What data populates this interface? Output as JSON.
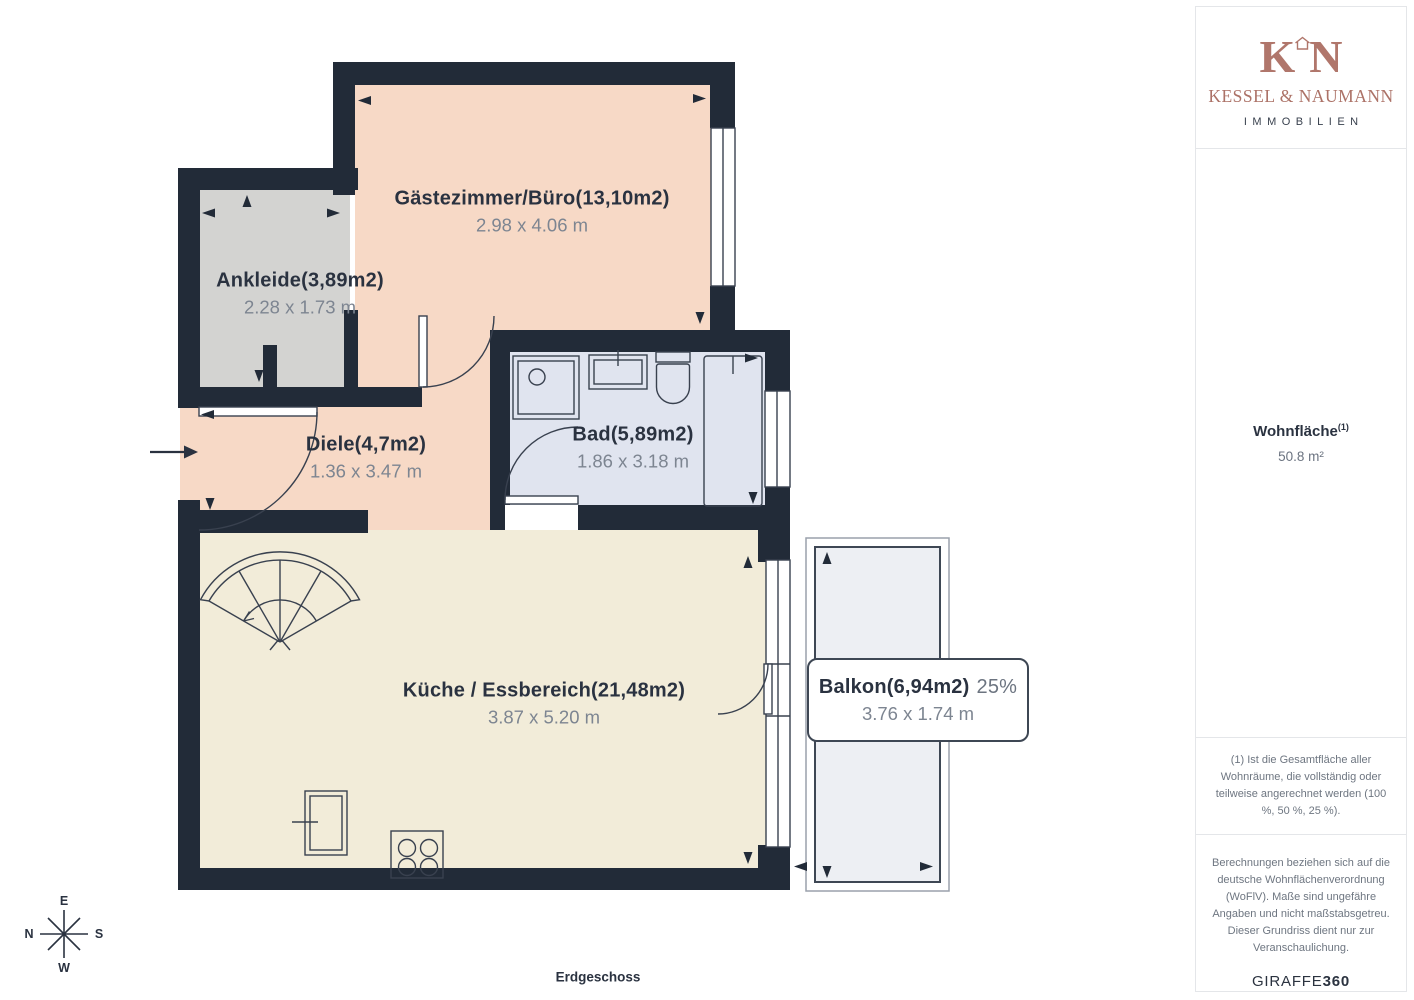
{
  "floor_label": "Erdgeschoss",
  "rooms": {
    "gaestezimmer": {
      "name": "Gästezimmer/Büro(13,10m2)",
      "dims": "2.98 x 4.06 m"
    },
    "ankleide": {
      "name": "Ankleide(3,89m2)",
      "dims": "2.28 x 1.73 m"
    },
    "diele": {
      "name": "Diele(4,7m2)",
      "dims": "1.36 x 3.47 m"
    },
    "bad": {
      "name": "Bad(5,89m2)",
      "dims": "1.86 x 3.18 m"
    },
    "kueche": {
      "name": "Küche / Essbereich(21,48m2)",
      "dims": "3.87 x 5.20 m"
    },
    "balkon": {
      "name": "Balkon(6,94m2)",
      "share": "25%",
      "dims": "3.76 x 1.74 m"
    }
  },
  "compass": {
    "top": "E",
    "left": "N",
    "right": "S",
    "bottom": "W"
  },
  "sidebar": {
    "logo": {
      "monogram_left": "K",
      "monogram_right": "N",
      "company": "KESSEL & NAUMANN",
      "tagline": "IMMOBILIEN"
    },
    "area": {
      "label": "Wohnfläche",
      "superscript": "(1)",
      "value": "50.8 m²"
    },
    "footnote": "(1) Ist die Gesamtfläche aller Wohnräume, die vollständig oder teilweise angerechnet werden (100 %, 50 %, 25 %).",
    "disclaimer": "Berechnungen beziehen sich auf die deutsche Wohnflächenverordnung (WoFlV). Maße sind ungefähre Angaben und nicht maßstabsgetreu. Dieser Grundriss dient nur zur Veranschaulichung.",
    "brand_name": "GIRAFFE",
    "brand_suffix": "360"
  },
  "colors": {
    "wall": "#222b38",
    "room_pink": "#f7d9c6",
    "room_gray": "#d3d3d1",
    "room_blue": "#e0e4ef",
    "room_cream": "#f2ecd9",
    "balcony": "#edeff3",
    "accent_rose": "#b0766b",
    "label_navy": "#2a3240",
    "dims_gray": "#7d8591"
  }
}
